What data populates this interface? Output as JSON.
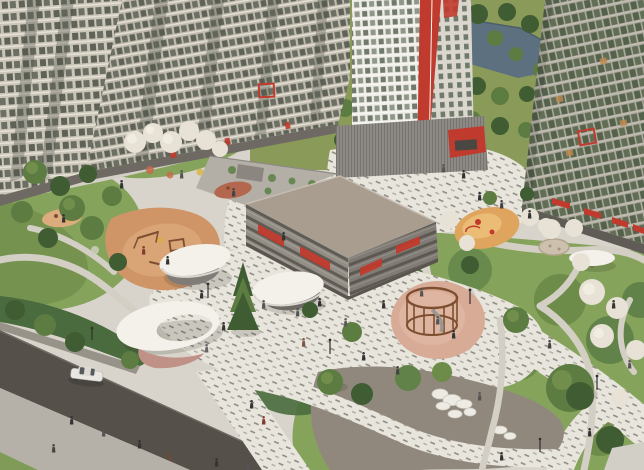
{
  "scene": {
    "type": "architectural-aerial-render",
    "title": "Aerial 3D render of a residential complex courtyard: apartment towers, parking podium, playgrounds, white shade canopies, winding park paths, street with sidewalk and a pond in the background park",
    "elements": {
      "buildings": [
        "left beige residential block",
        "white tower with red vertical stripe",
        "right residential tower with green glass",
        "grey parking podium with red accents"
      ],
      "landscape": [
        "wooden playground with orange rubber surface",
        "round rope-climbing playground",
        "small amber playground",
        "three organic white canopies with pavilions",
        "spruce tree",
        "blossoming white trees",
        "winding gravel paths",
        "asphalt street with white car and sidewalk",
        "boulder garden on taupe plaza",
        "pond in background park"
      ],
      "highlighted_apartment_markers": 2,
      "canopy_count": 3,
      "playground_count": 4
    }
  },
  "palette": {
    "park-grass": "#8a9a58",
    "park-tree-dark": "#3f5c33",
    "park-tree-mid": "#5d7c42",
    "park-tree-light": "#7e9b54",
    "water": "#5d7080",
    "ground": "#d8d4cb",
    "paver": "#e8e5dd",
    "paver-dash": "#8f8c84",
    "path": "#d3cfc5",
    "path-dark": "#716d66",
    "road": "#55504a",
    "sidewalk": "#b6b1a8",
    "grass": "#7f9b57",
    "lawn": "#86a35b",
    "lawn-dark": "#6d8c49",
    "shrub-dark": "#4a6b3d",
    "shrub-mid": "#61834a",
    "blossom": "#e7e2d5",
    "bldg-wall": "#ccc6b9",
    "bldg-wall2": "#c2bcaf",
    "bldg-win": "#5e6257",
    "bldg-win2": "#6c7064",
    "bldg-floor": "#e6e1d6",
    "tower-white": "#eeece6",
    "tower-shade": "#dbd7ce",
    "tower-win": "#707a6b",
    "accent-red": "#c03b2d",
    "rbldg-band": "#b1ada2",
    "rbldg-glass": "#55624b",
    "rbldg-glass2": "#616e55",
    "pod-roof": "#a89d8f",
    "pod-wall": "#928e86",
    "pod-wall2": "#807c75",
    "pod-dark": "#56524d",
    "pg-orange": "#cf9566",
    "pg-orange-light": "#dcab7e",
    "pg-pink": "#d8ab97",
    "pg-pink-light": "#e0b8a4",
    "pg-amber": "#dfa45e",
    "pg-rust": "#b4674f",
    "canopy": "#f3f1ea",
    "canopy-shade": "#d9d6cf",
    "pavilion": "#807b76",
    "pavilion-pink": "#bf9187",
    "wood": "#7d4e30",
    "rock": "#edebe4",
    "plaza-taupe": "#91887d",
    "car-white": "#e9e7e2"
  }
}
